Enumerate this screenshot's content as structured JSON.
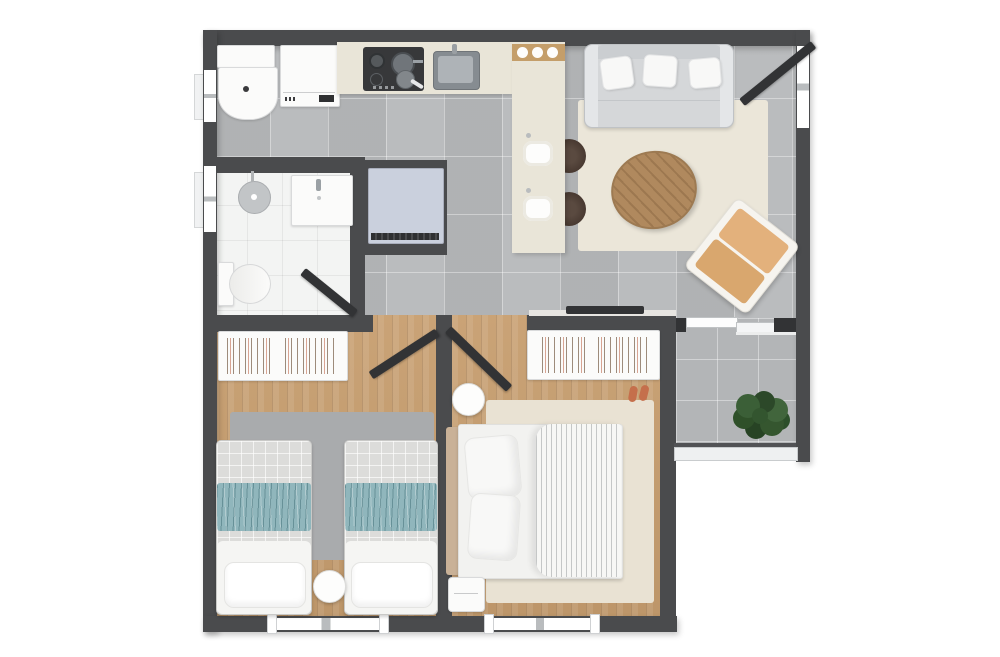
{
  "meta": {
    "title": "Top-down 3D rendered apartment floor plan with kitchen, living room, bathroom, two bedrooms and balcony",
    "image_type": "floor-plan-render",
    "visible_text": ""
  },
  "colors": {
    "wall": "#4a4b4d",
    "wallDeep": "#323335",
    "tile": "#b6b8ba",
    "balconyTile": "#b3b5b7",
    "bathFloor": "#f3f4f3",
    "wood": "#c79e6f",
    "rugLiving": "#ebe6d9",
    "rugMaster": "#e9e2d3",
    "rugTwin": "#a9abad",
    "counter": "#e9e5d8",
    "islandCap": "#c49e6a",
    "sofa": "#d5d7d9",
    "sofaArm": "#e4e6e8",
    "sofaBack": "#cbced1",
    "pillow": "#f8f8f7",
    "coffeeTable": "#b0895e",
    "armchairFrame": "#f6f4ef",
    "armchairBack": "#e3b17c",
    "armchairSeat": "#d9a76e",
    "teal": "#90b6bc",
    "quilt": "#dcdcda",
    "bedWhite": "#f5f5f3",
    "headboard": "#c9b197",
    "fridge": "#cad0dd",
    "cooktop": "#37383a",
    "steel": "#979da3",
    "stool": "#46372f",
    "plantGreen": "#33552f",
    "railing": "#eef0f1",
    "windowWhite": "#ffffff",
    "frameGray": "#b9bcbe",
    "slipper": "#c56f4b"
  }
}
